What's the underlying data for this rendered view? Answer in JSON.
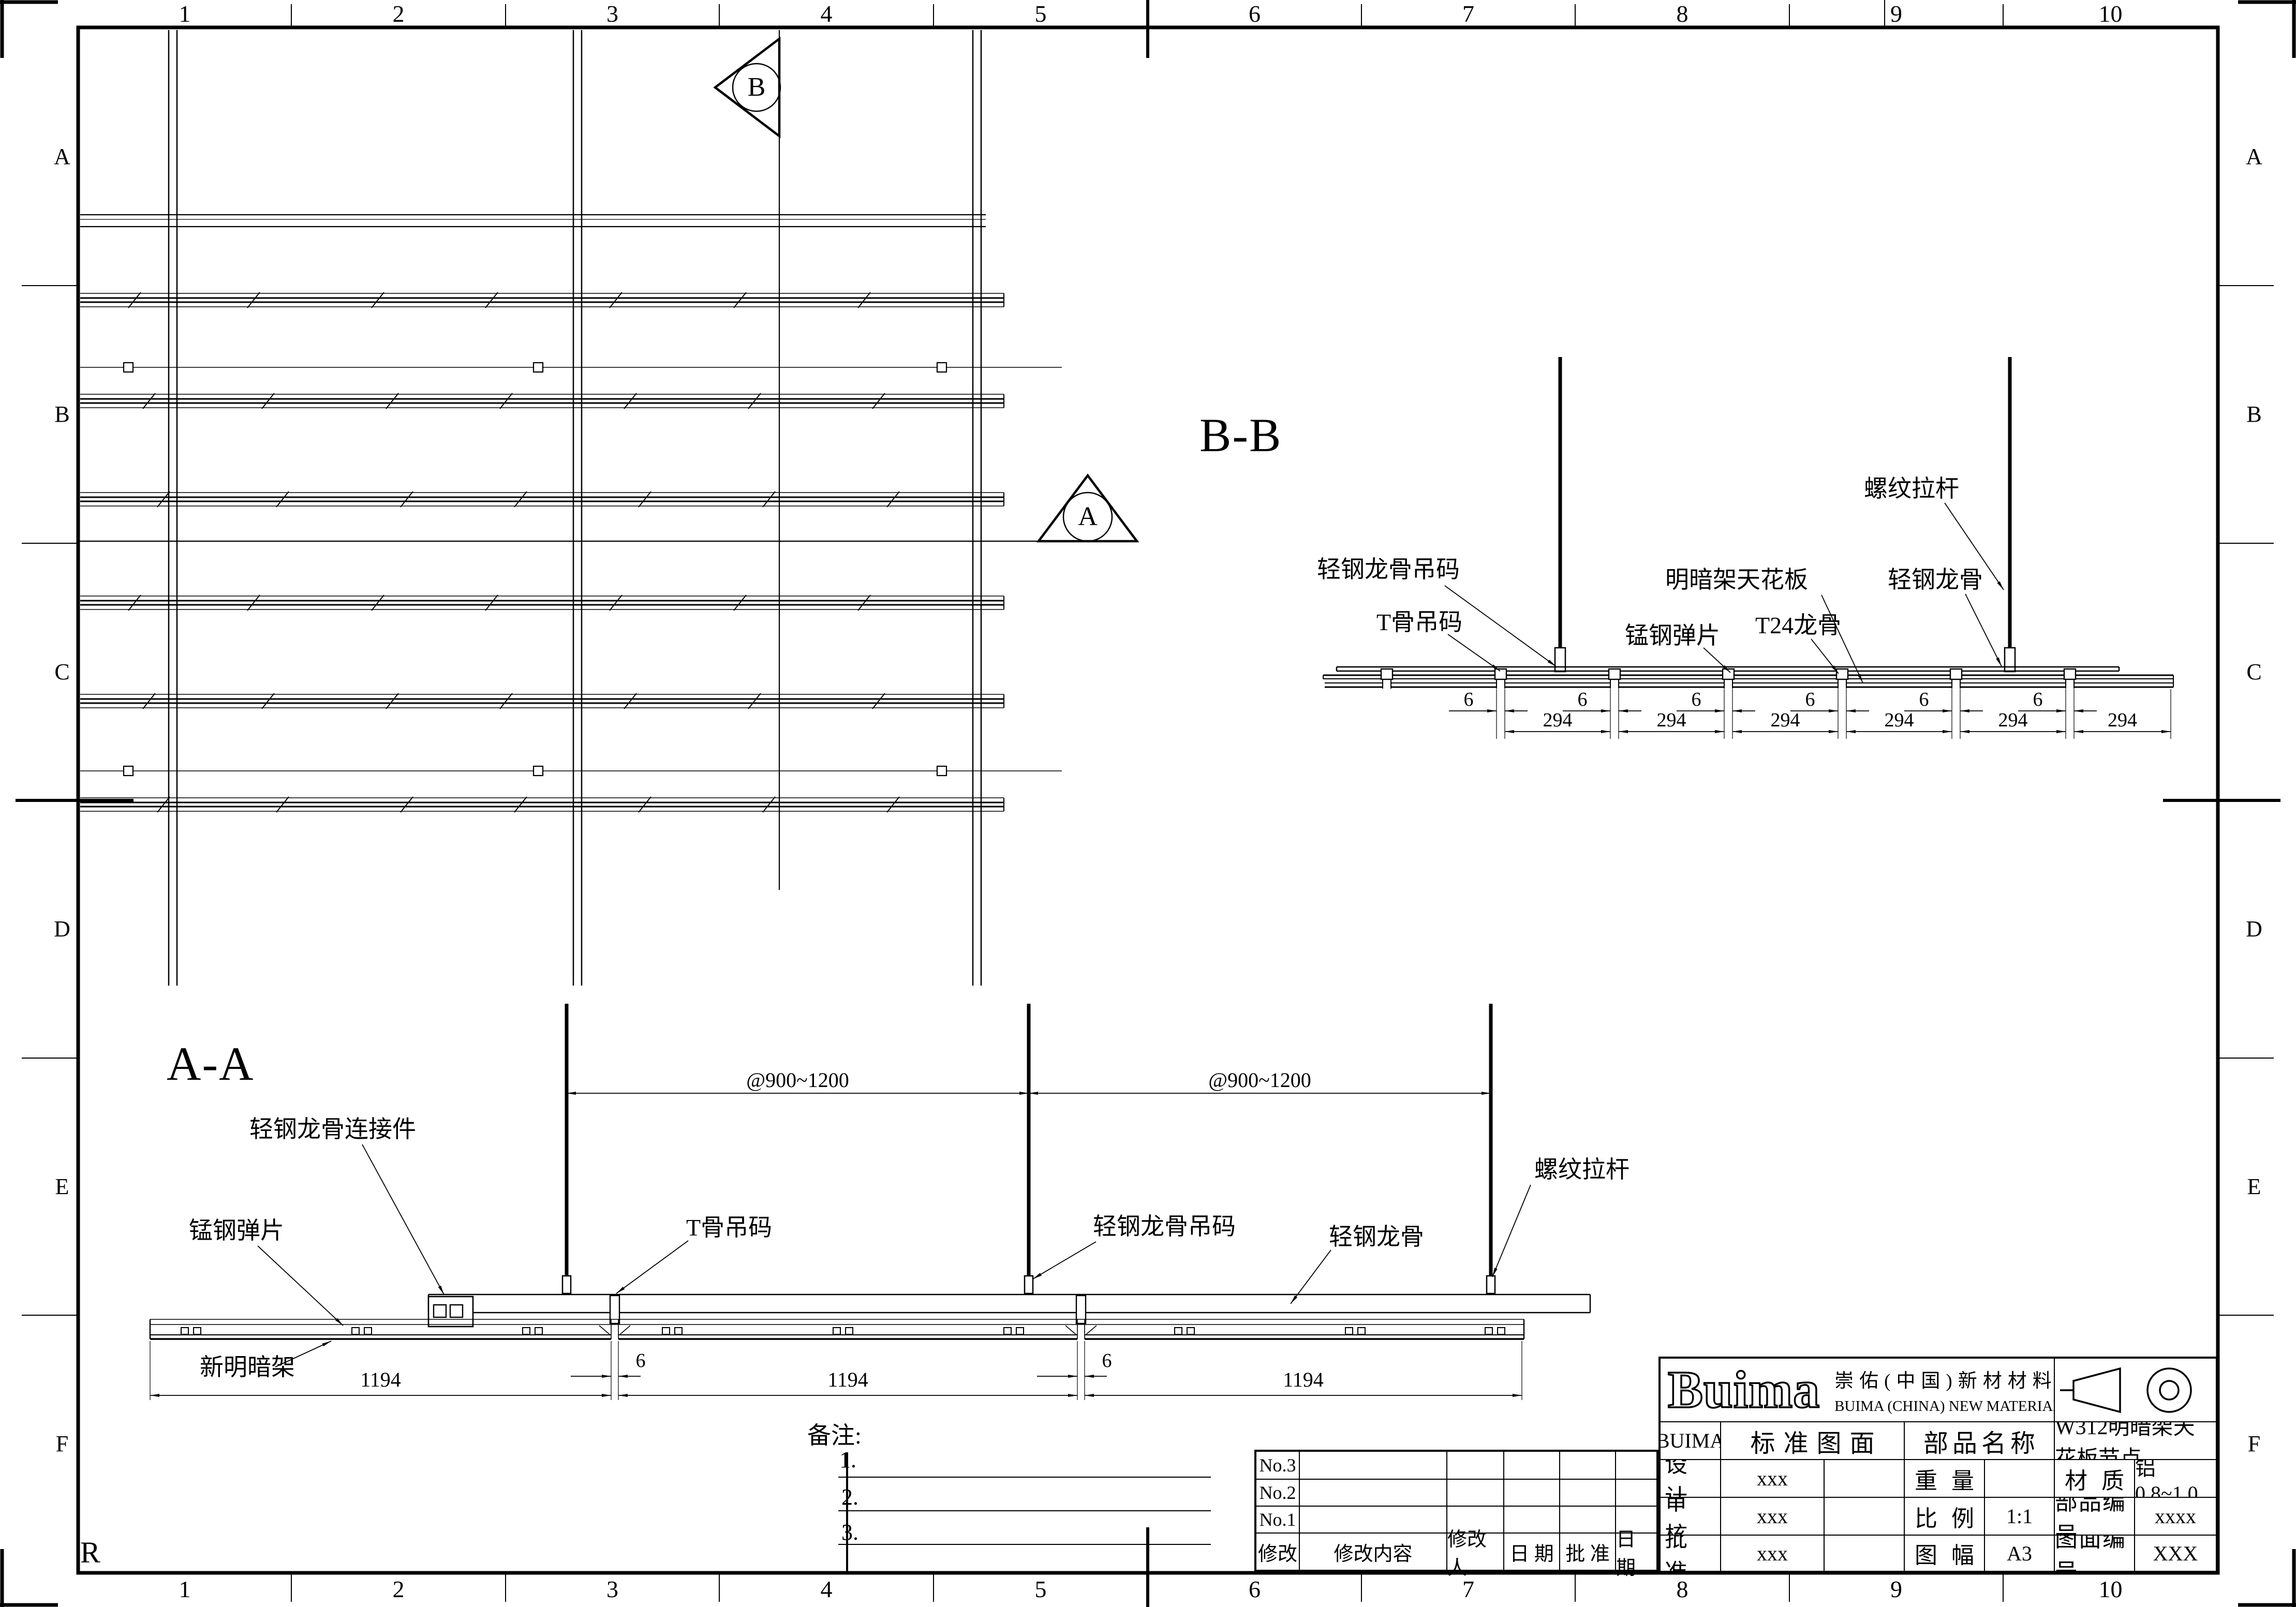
{
  "sheet": {
    "paper": "#ffffff",
    "ink": "#000000",
    "cols": [
      "1",
      "2",
      "3",
      "4",
      "5",
      "6",
      "7",
      "8",
      "9",
      "10"
    ],
    "rows": [
      "A",
      "B",
      "C",
      "D",
      "E",
      "F"
    ],
    "corner_mark": "R"
  },
  "plan": {
    "marker_a": "A",
    "marker_b": "B"
  },
  "bb": {
    "title": "B-B",
    "dim_gap": "6",
    "dim_span": "294",
    "labels": [
      "轻钢龙骨吊码",
      "T骨吊码",
      "锰钢弹片",
      "明暗架天花板",
      "T24龙骨",
      "螺纹拉杆",
      "轻钢龙骨"
    ]
  },
  "aa": {
    "title": "A-A",
    "dim_spacing": "@900~1200",
    "dim_gap": "6",
    "dim_panel": "1194",
    "labels": [
      "轻钢龙骨连接件",
      "锰钢弹片",
      "T骨吊码",
      "轻钢龙骨吊码",
      "轻钢龙骨",
      "螺纹拉杆",
      "新明暗架"
    ]
  },
  "notes": {
    "title": "备注:",
    "items": [
      "1.",
      "2.",
      "3."
    ]
  },
  "revision": {
    "rows": [
      "No.3",
      "No.2",
      "No.1"
    ],
    "headers": [
      "修改",
      "修改内容",
      "修改人",
      "日 期",
      "批 准",
      "日 期"
    ]
  },
  "titleblock": {
    "logo": "Buima",
    "company_cn": "崇佑(中国)新材材料有限公司",
    "company_en": "BUIMA (CHINA) NEW MATERIALS CO.,LTD.",
    "brand": "BUIMA",
    "std_drawing": "标准图面",
    "part_name_label": "部品名称",
    "part_name": "W312明暗架天花板节点",
    "rows": [
      {
        "label": "设 计",
        "value": "xxx",
        "k2": "重 量",
        "v2": "",
        "k3": "材 质",
        "v3": "铝0.8~1.0"
      },
      {
        "label": "审 核",
        "value": "xxx",
        "k2": "比 例",
        "v2": "1:1",
        "k3": "部品编号",
        "v3": "xxxx"
      },
      {
        "label": "批 准",
        "value": "xxx",
        "k2": "图 幅",
        "v2": "A3",
        "k3": "图面编号",
        "v3": "XXX"
      }
    ]
  }
}
